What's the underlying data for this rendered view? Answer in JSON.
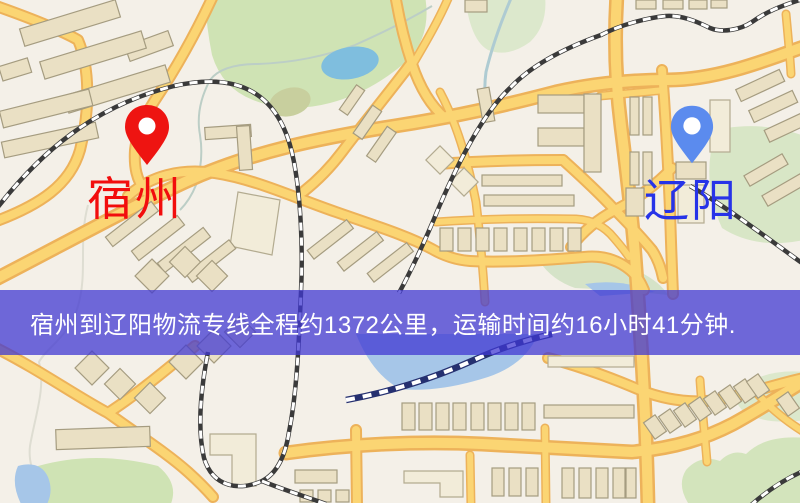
{
  "banner": {
    "text": "宿州到辽阳物流专线全程约1372公里，运输时间约16小时41分钟.",
    "background_color": "rgba(64,55,210,0.74)",
    "text_color": "#ffffff"
  },
  "markers": {
    "origin": {
      "label": "宿州",
      "pin_color": "#ee1411",
      "label_color": "#f20d0d"
    },
    "destination": {
      "label": "辽阳",
      "pin_color": "#5b8bee",
      "label_color": "#2733e8"
    }
  },
  "map_palette": {
    "background": "#f4f0e8",
    "road_fill": "#fbd573",
    "road_casing": "#edb25a",
    "building_fill": "#eae0c4",
    "building_stroke": "#a59c80",
    "park_green": "#cfe3b4",
    "water_blue": "#8cc6e8",
    "railway": "#3a3a3a",
    "railway_water": "#253070"
  }
}
